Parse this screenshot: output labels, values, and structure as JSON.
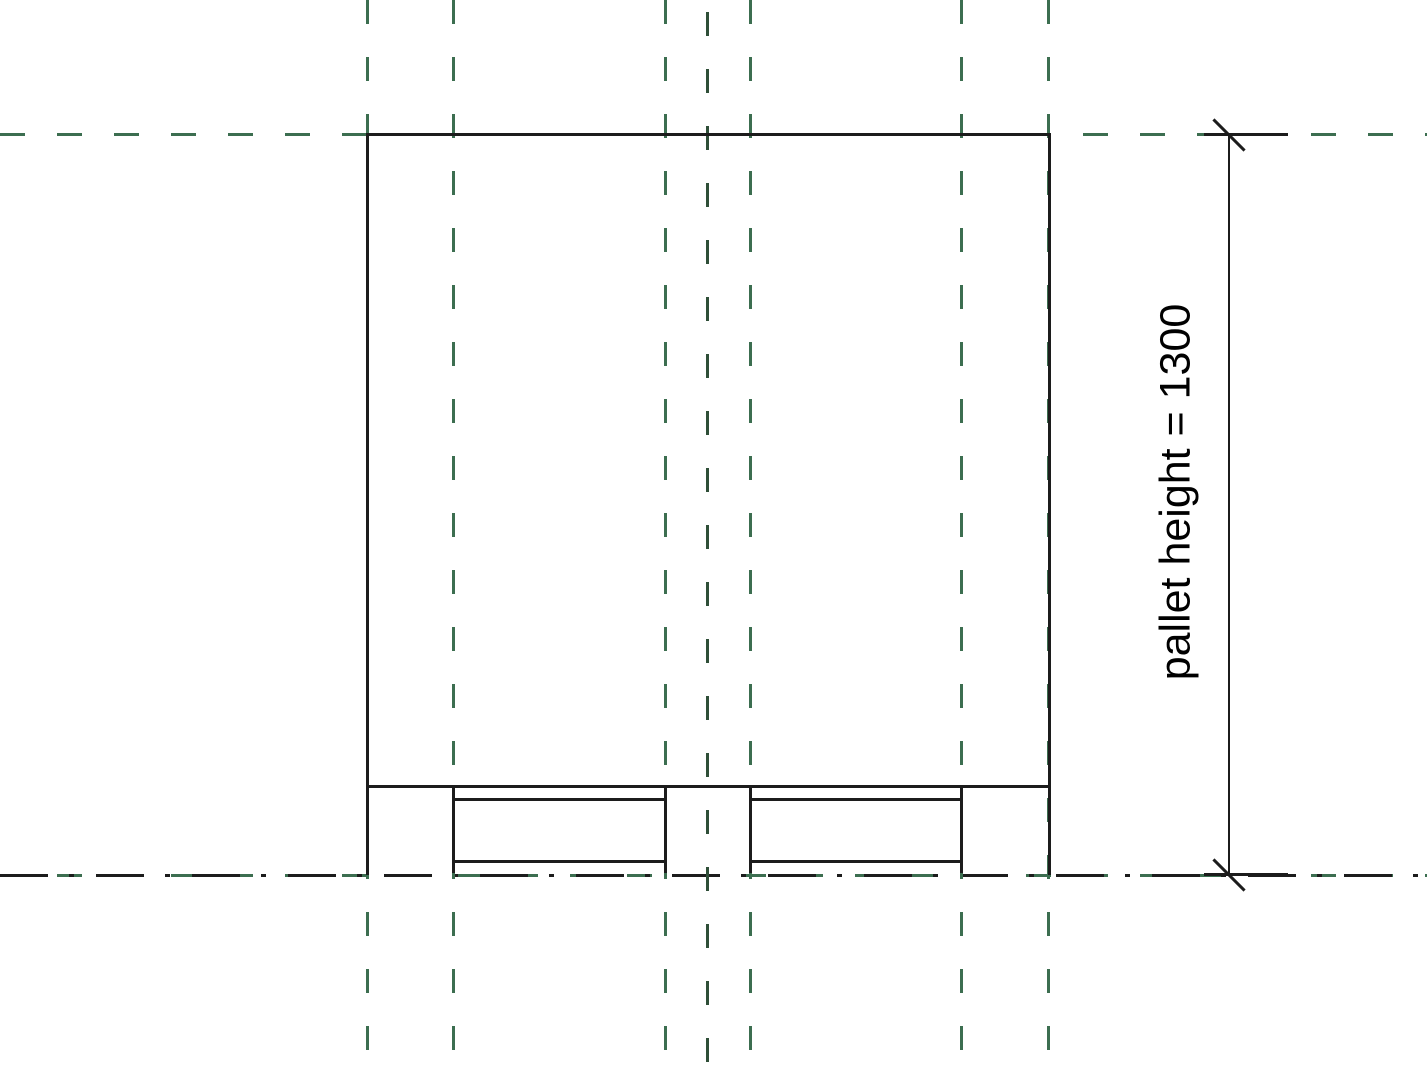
{
  "dimension": {
    "label": "pallet height = 1300",
    "parameter_name": "pallet height",
    "value": "1300"
  },
  "colors": {
    "reference_plane_green": "#3c6e50",
    "center_axis_dark_green": "#2f4f38",
    "ink": "#1c1c1c",
    "background": "#ffffff"
  }
}
